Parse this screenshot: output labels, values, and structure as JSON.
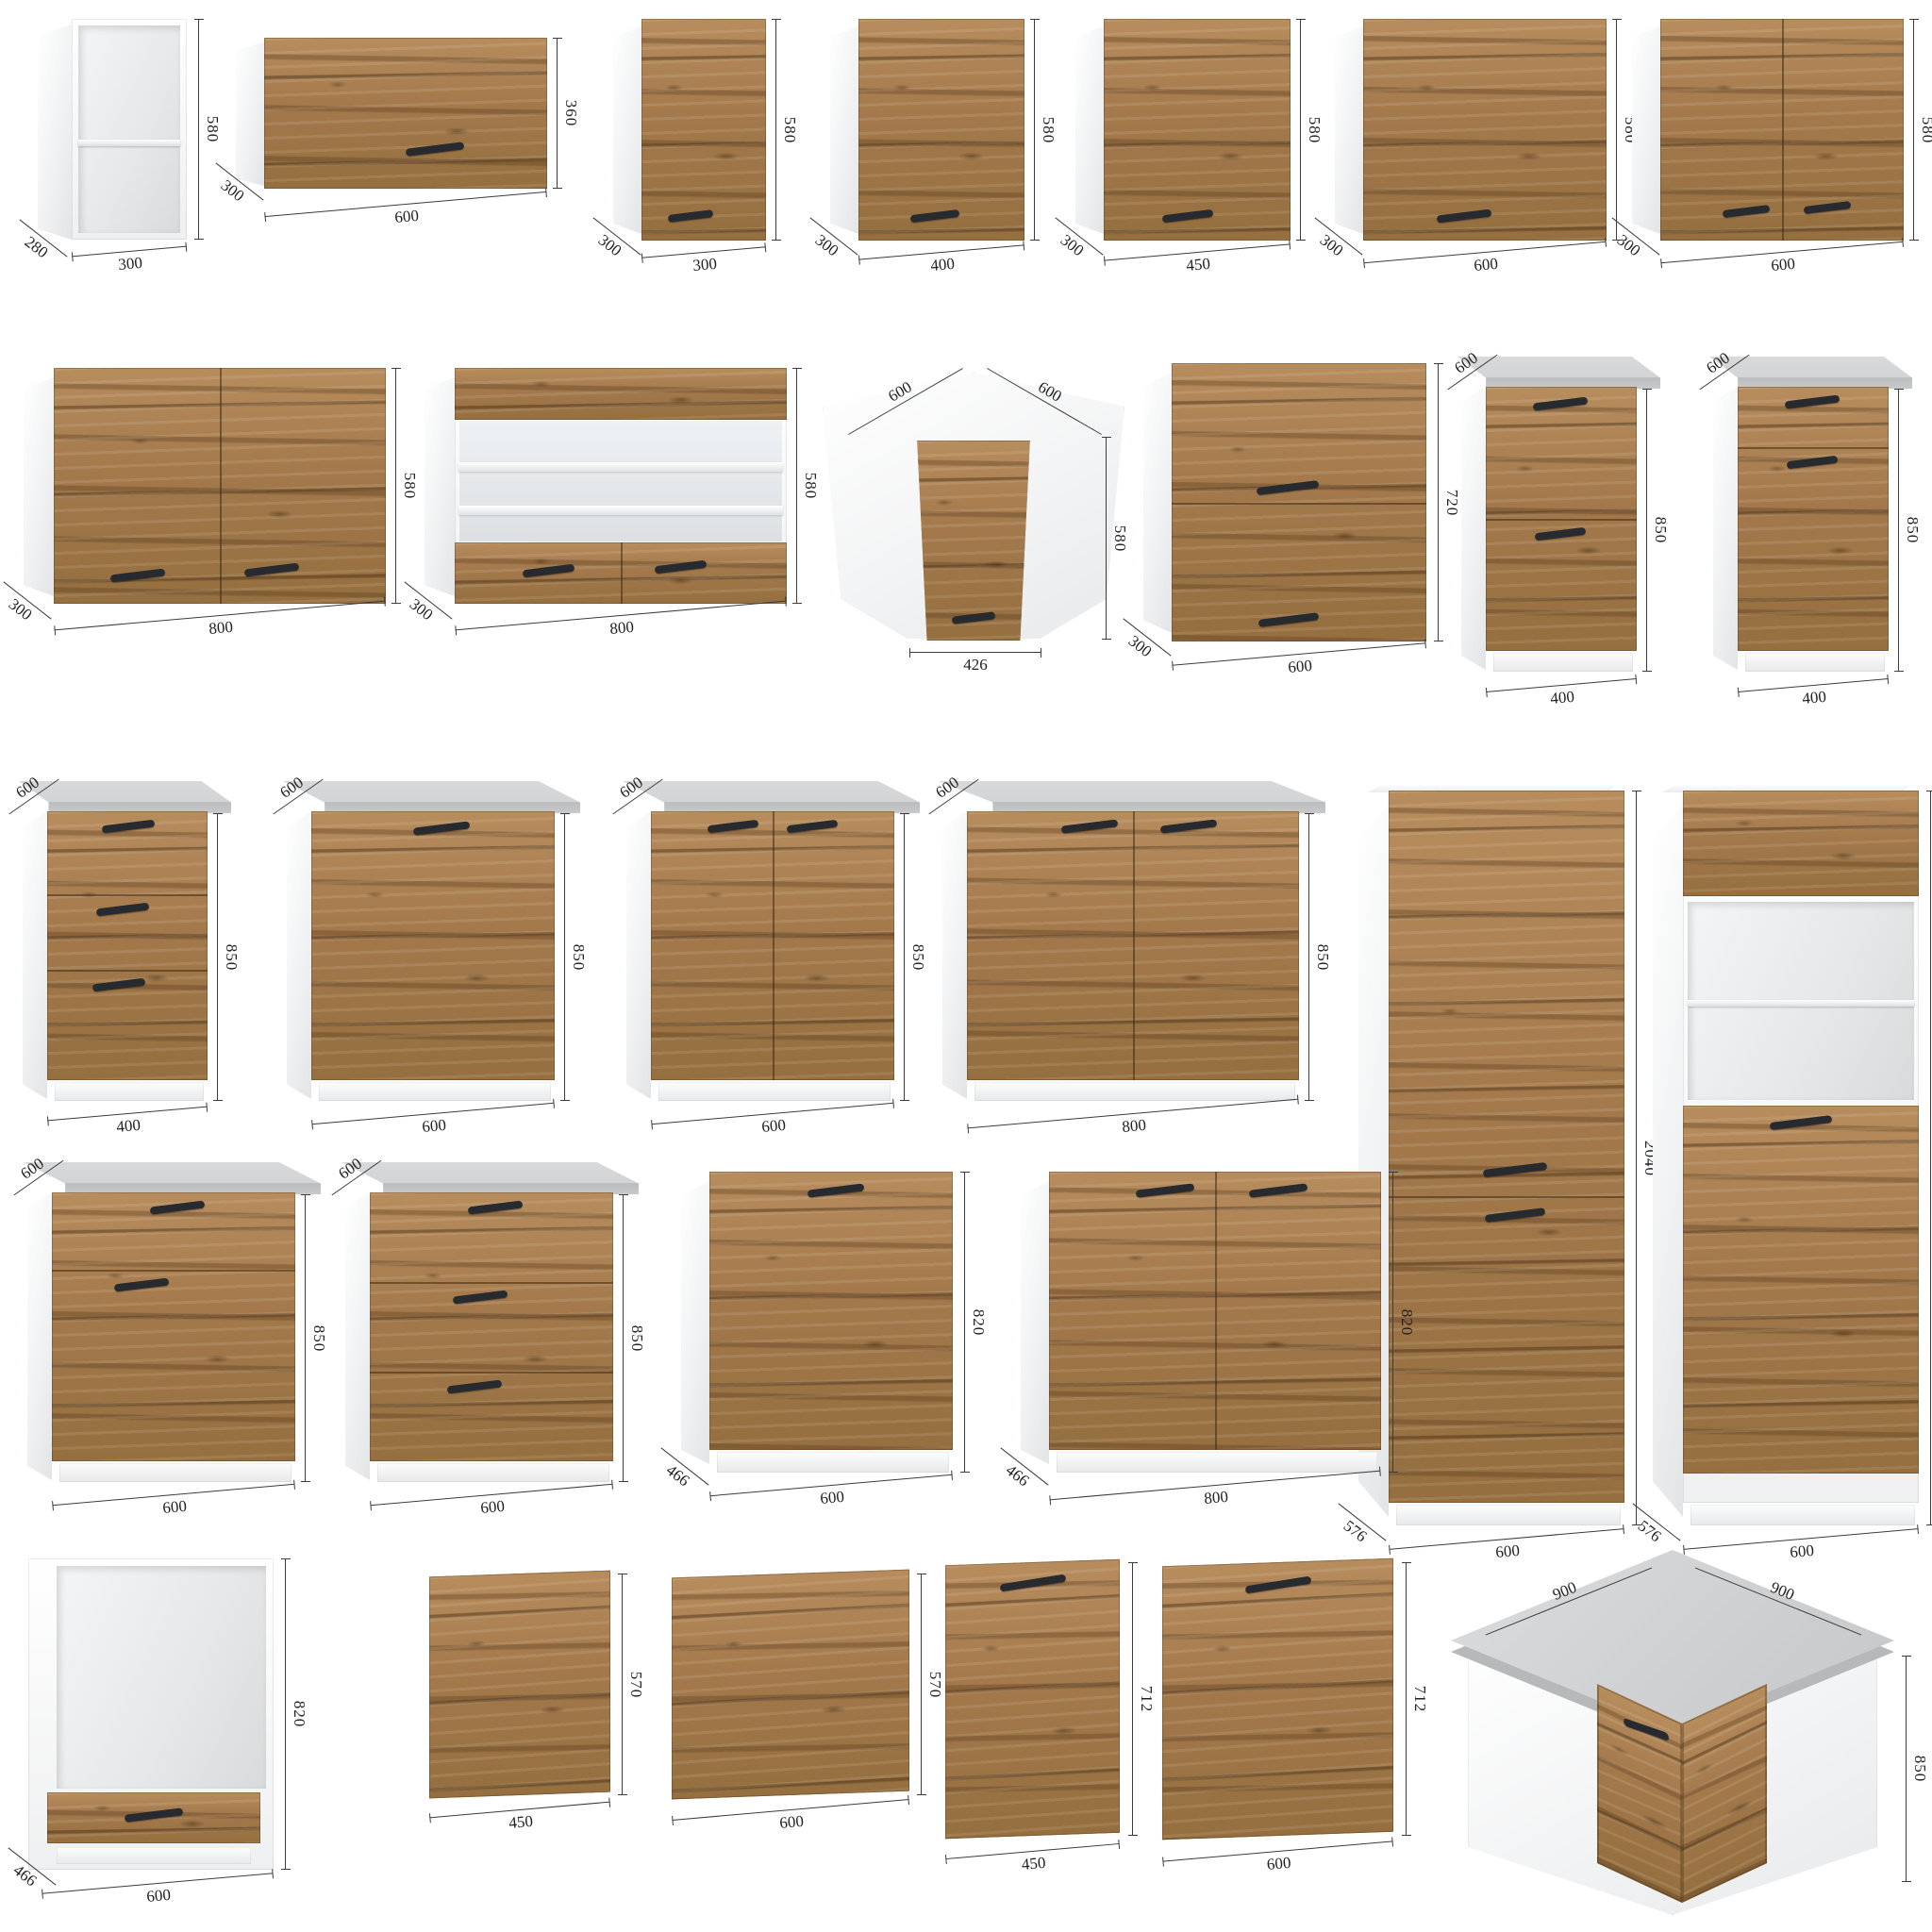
{
  "colors": {
    "wood": "#a57c4f",
    "wood_dark": "#6b4a26",
    "handle": "#272a2f",
    "countertop": "#cdcfd1",
    "carcass_white": "#f2f3f4",
    "dimension_line": "#3c3c3c"
  },
  "cabinets": {
    "c01": {
      "w": "300",
      "h": "580",
      "d": "280"
    },
    "c02": {
      "w": "600",
      "h": "360",
      "d": "300"
    },
    "c03": {
      "w": "300",
      "h": "580",
      "d": "300"
    },
    "c04": {
      "w": "400",
      "h": "580",
      "d": "300"
    },
    "c05": {
      "w": "450",
      "h": "580",
      "d": "300"
    },
    "c06": {
      "w": "600",
      "h": "580",
      "d": "300"
    },
    "c07": {
      "w": "600",
      "h": "580",
      "d": "300"
    },
    "c08": {
      "w": "800",
      "h": "580",
      "d": "300"
    },
    "c09": {
      "w": "800",
      "h": "580",
      "d": "300"
    },
    "c10": {
      "wl": "600",
      "wr": "600",
      "h": "580",
      "w": "426"
    },
    "c11": {
      "w": "600",
      "h": "720",
      "d": "300"
    },
    "c12": {
      "w": "400",
      "h": "850",
      "d": "600"
    },
    "c13": {
      "w": "400",
      "h": "850",
      "d": "600"
    },
    "c14": {
      "w": "400",
      "h": "850",
      "d": "600"
    },
    "c15": {
      "w": "600",
      "h": "850",
      "d": "600"
    },
    "c16": {
      "w": "600",
      "h": "850",
      "d": "600"
    },
    "c17": {
      "w": "800",
      "h": "850",
      "d": "600"
    },
    "c18": {
      "w": "600",
      "h": "2040",
      "d": "576"
    },
    "c19": {
      "w": "600",
      "h": "2040",
      "d": "576"
    },
    "c20": {
      "w": "600",
      "h": "850",
      "d": "600"
    },
    "c21": {
      "w": "600",
      "h": "850",
      "d": "600"
    },
    "c22": {
      "w": "600",
      "h": "820",
      "d": "466"
    },
    "c23": {
      "w": "800",
      "h": "820",
      "d": "466"
    },
    "c24": {
      "w": "600",
      "h": "820",
      "d": "466"
    },
    "c25": {
      "w": "450",
      "h": "570"
    },
    "c26": {
      "w": "600",
      "h": "570"
    },
    "c27": {
      "w": "450",
      "h": "712"
    },
    "c28": {
      "w": "600",
      "h": "712"
    },
    "c29": {
      "wl": "900",
      "wr": "900",
      "h": "850"
    }
  }
}
